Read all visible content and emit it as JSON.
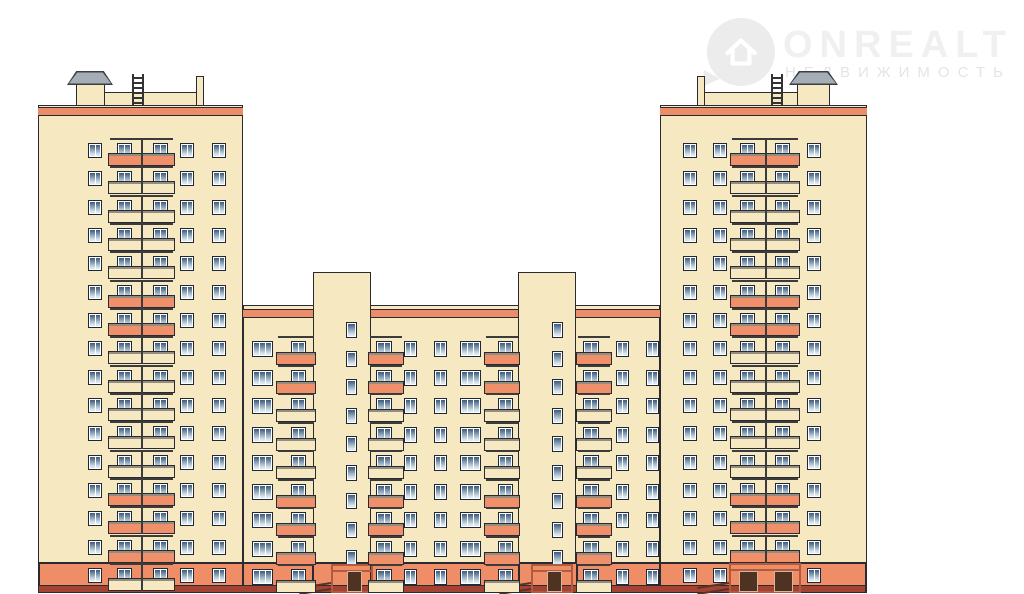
{
  "watermark": {
    "brand": "ONREALT",
    "subtitle": "НЕДВИЖИМОСТЬ"
  },
  "palette": {
    "background": "#ffffff",
    "wall_cream": "#f6e9c2",
    "balcony_salmon": "#f0906a",
    "parapet_stripe": "#eb8d68",
    "base_salmon": "#ef8d67",
    "base_dark_strip": "#a24334",
    "outline": "#2a2a30",
    "railing": "#3b3b3b",
    "slab_edge": "#938d80",
    "window_frame": "#ffffff",
    "window_border": "#1d2736",
    "pane_top": "#3c5878",
    "pane_mid": "#8ba3b8",
    "pane_bottom": "#dde9f1",
    "roof_cap_gray": "#a7adb5",
    "roof_cap_stroke": "#3a3f46",
    "door_brown": "#4f3322",
    "door_trim": "#d8b49a",
    "portal_line": "#b05a3e",
    "ramp_line": "#5a3227",
    "ladder_dark": "#333333"
  },
  "facade": {
    "canvas": {
      "w": 1024,
      "h": 594
    },
    "base": {
      "x": 38,
      "w": 828,
      "y": 562,
      "h": 23,
      "strip_h": 8,
      "vlines": [
        38,
        242,
        312,
        370,
        518,
        576,
        659,
        865
      ]
    },
    "left_tower": {
      "x": 38,
      "w": 205,
      "top": 105,
      "stripe_y": 107,
      "stripe_h": 9,
      "floors": 16,
      "row0": 143,
      "step": 28.33,
      "win_h": 15,
      "cols": [
        {
          "x": 88,
          "w": 14,
          "p": 2
        },
        {
          "x": 180,
          "w": 14,
          "p": 2
        },
        {
          "x": 212,
          "w": 14,
          "p": 2
        }
      ],
      "bal": {
        "slab_x": 108,
        "slab_w": 67,
        "div_x": 141,
        "wins": [
          {
            "x": 117,
            "w": 15
          },
          {
            "x": 153,
            "w": 15
          }
        ]
      },
      "pattern": "SCCCCSSCCCCCSSSC",
      "roof": [
        {
          "t": "box",
          "x": 103,
          "y": 92,
          "w": 97,
          "h": 15
        },
        {
          "t": "box",
          "x": 76,
          "y": 81,
          "w": 29,
          "h": 26
        },
        {
          "t": "cap",
          "x": 68,
          "y": 72,
          "w": 44,
          "h": 12
        },
        {
          "t": "lad",
          "x": 132,
          "y": 74,
          "w": 12,
          "h": 31
        },
        {
          "t": "box",
          "x": 196,
          "y": 76,
          "w": 8,
          "h": 31
        }
      ]
    },
    "right_tower": {
      "x": 660,
      "w": 207,
      "top": 105,
      "stripe_y": 107,
      "stripe_h": 9,
      "floors": 16,
      "row0": 143,
      "step": 28.33,
      "win_h": 15,
      "cols": [
        {
          "x": 683,
          "w": 14,
          "p": 2
        },
        {
          "x": 713,
          "w": 14,
          "p": 2
        },
        {
          "x": 807,
          "w": 14,
          "p": 2
        }
      ],
      "bal": {
        "slab_x": 730,
        "slab_w": 70,
        "div_x": 765,
        "wins": [
          {
            "x": 740,
            "w": 15
          },
          {
            "x": 775,
            "w": 15
          }
        ]
      },
      "pattern": "SCCCCSSCCCCCSSSE",
      "roof": [
        {
          "t": "box",
          "x": 700,
          "y": 92,
          "w": 100,
          "h": 15
        },
        {
          "t": "box",
          "x": 797,
          "y": 81,
          "w": 33,
          "h": 26
        },
        {
          "t": "cap",
          "x": 790,
          "y": 72,
          "w": 47,
          "h": 12
        },
        {
          "t": "lad",
          "x": 771,
          "y": 74,
          "w": 12,
          "h": 31
        },
        {
          "t": "box",
          "x": 697,
          "y": 76,
          "w": 8,
          "h": 31
        }
      ],
      "entrance": {
        "portal_x": 729,
        "portal_w": 72,
        "portal_y": 563,
        "doors": [
          {
            "x": 739,
            "w": 19
          },
          {
            "x": 774,
            "w": 19
          }
        ],
        "door_y": 571,
        "door_h": 21,
        "ramp_x": 697
      }
    },
    "middle": {
      "x": 243,
      "w": 417,
      "top": 305,
      "stripe_y": 309,
      "stripe_h": 9,
      "rows": 9,
      "row0": 341,
      "step": 28.5,
      "win_h": 16,
      "stairs": [
        {
          "x": 313,
          "w": 58,
          "top": 272,
          "win_x": 346,
          "entrance": {
            "portal_x": 331,
            "portal_w": 42,
            "door_x": 347,
            "door_w": 15,
            "ramp_x": 299
          }
        },
        {
          "x": 518,
          "w": 58,
          "top": 272,
          "win_x": 552,
          "entrance": {
            "portal_x": 531,
            "portal_w": 42,
            "door_x": 547,
            "door_w": 15,
            "ramp_x": 499
          }
        }
      ],
      "stair_win": {
        "w": 11,
        "h": 16,
        "dy": -19
      },
      "cols": [
        {
          "x": 252,
          "w": 21,
          "p": 3
        },
        {
          "x": 404,
          "w": 13,
          "p": 2
        },
        {
          "x": 434,
          "w": 13,
          "p": 2
        },
        {
          "x": 460,
          "w": 21,
          "p": 3
        },
        {
          "x": 616,
          "w": 13,
          "p": 2
        },
        {
          "x": 646,
          "w": 13,
          "p": 2
        }
      ],
      "bals": [
        {
          "slab_x": 276,
          "slab_w": 40,
          "win_x": 291,
          "win_w": 15
        },
        {
          "slab_x": 368,
          "slab_w": 36,
          "win_x": 376,
          "win_w": 16
        },
        {
          "slab_x": 484,
          "slab_w": 36,
          "win_x": 498,
          "win_w": 15
        },
        {
          "slab_x": 576,
          "slab_w": 36,
          "win_x": 583,
          "win_w": 16
        }
      ],
      "pattern": "SSCCCSSSC"
    }
  }
}
